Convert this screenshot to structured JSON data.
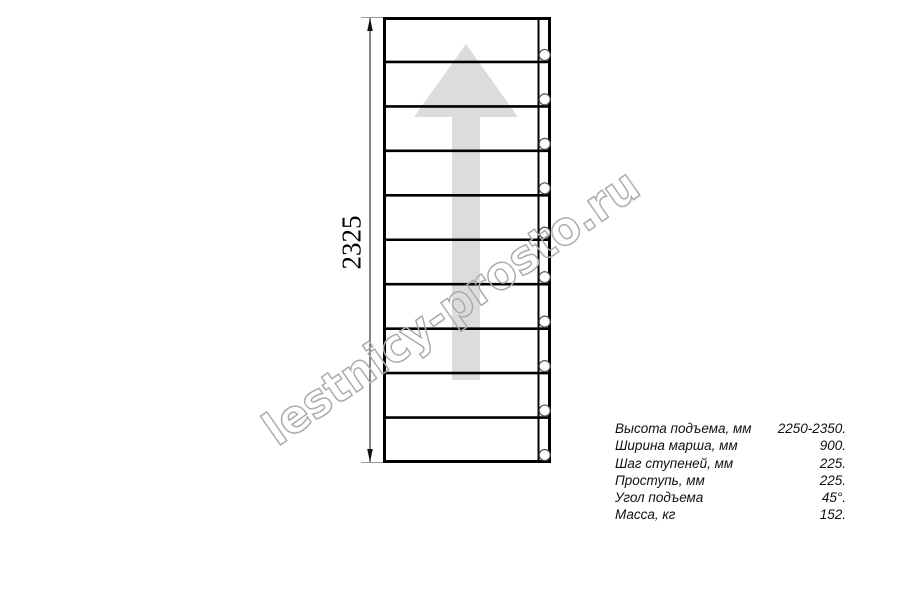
{
  "watermark": {
    "text": "lestnicy-prosto.ru",
    "color": "#ababab"
  },
  "drawing": {
    "dimension_label": "2325",
    "step_count": 10,
    "arrow_color": "#dcdcdc",
    "line_color": "#000000",
    "marker_count": 10
  },
  "specs": {
    "rows": [
      {
        "label": "Высота подъема, мм",
        "value": "2250-2350."
      },
      {
        "label": "Ширина марша, мм",
        "value": "900."
      },
      {
        "label": "Шаг ступеней, мм",
        "value": "225."
      },
      {
        "label": "Проступь, мм",
        "value": "225."
      },
      {
        "label": "Угол подъема",
        "value": "45°."
      },
      {
        "label": "Масса, кг",
        "value": "152."
      }
    ]
  }
}
